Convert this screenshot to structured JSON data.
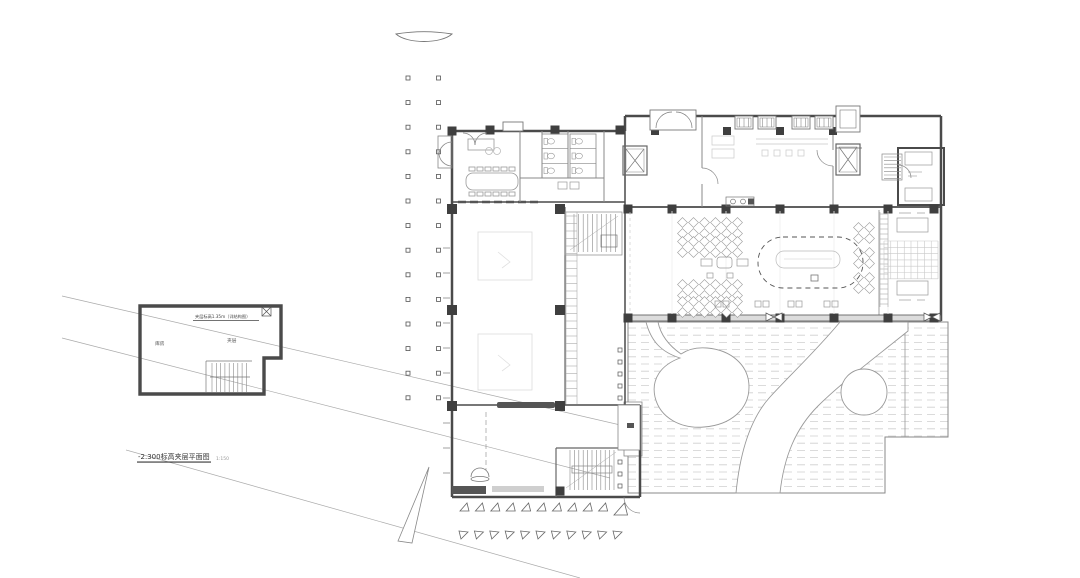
{
  "drawing_title": "-2.300标高夹层平面图",
  "labels": {
    "plan_title": "-2.300标高夹层平面图",
    "plan_scale": "1:150",
    "mezz_note": "夹层标高1.35m（详结构图）",
    "mezz_room_left": "库房",
    "mezz_room_right": "夹层"
  },
  "colors": {
    "paper": "#ffffff",
    "wall": "#4a4a4a",
    "column": "#3f3f3f",
    "partition": "#888888",
    "furniture": "#999999",
    "faint": "#c9c9c9",
    "deck_dash": "#cfcfcf",
    "leader": "#aaaaaa"
  },
  "drawing": {
    "colonnade": {
      "columns": 2,
      "dots_per_column": 14
    },
    "site_markers": {
      "row1_count": 11,
      "row2_count": 11
    },
    "hall_table_clusters": 15,
    "terrace_deck_lines": 23,
    "wall_tick_count": 10
  }
}
